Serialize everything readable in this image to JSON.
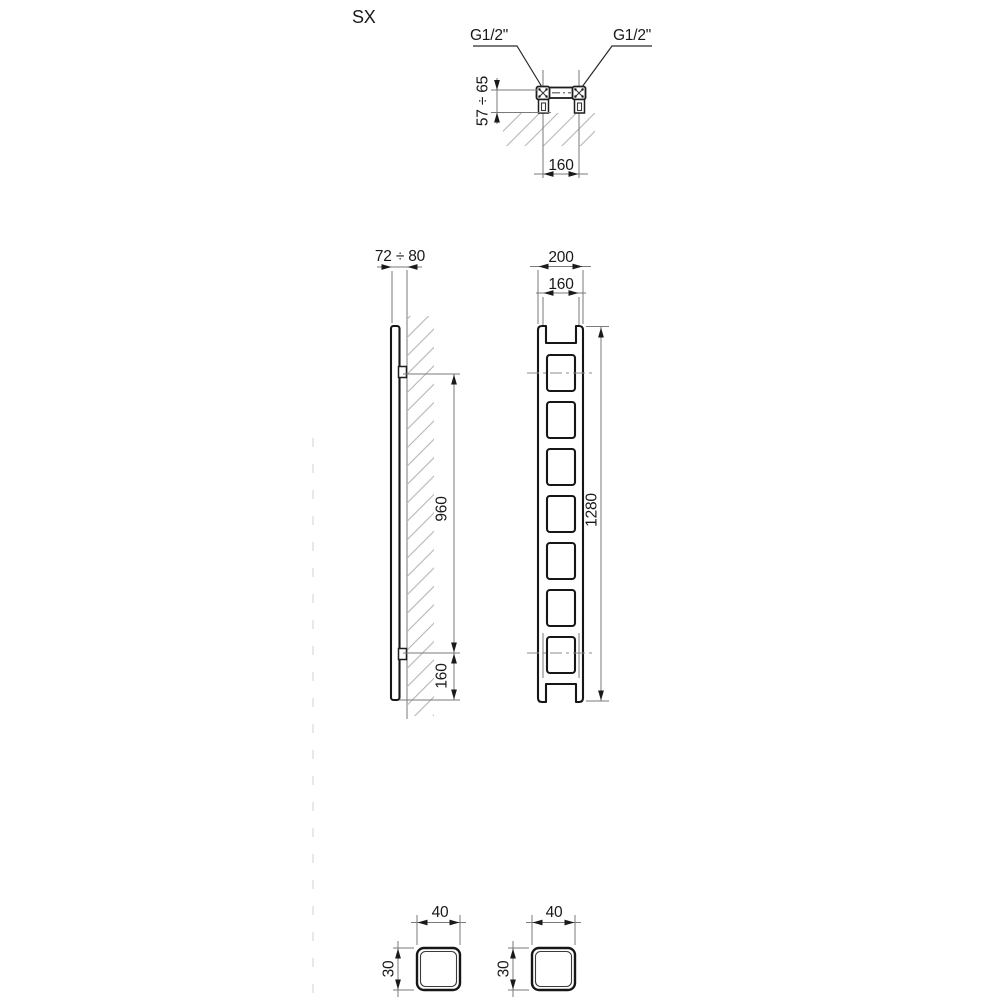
{
  "colors": {
    "background": "#ffffff",
    "outline": "#161616",
    "dimension_lines": "#7a7a7a",
    "hatch": "#b6b6b6",
    "fold_line": "#dcdcdc"
  },
  "drawing": {
    "model_label": "SX",
    "top_view": {
      "connection_left_label": "G1/2\"",
      "connection_right_label": "G1/2\"",
      "wall_clearance": "57 ÷ 65",
      "connection_spacing": "160"
    },
    "side_view": {
      "depth_from_wall": "72 ÷ 80",
      "bracket_spacing": "960",
      "bracket_bottom_offset": "160"
    },
    "front_view": {
      "overall_width": "200",
      "connection_spacing": "160",
      "overall_height": "1280"
    },
    "tube_sections": {
      "left": {
        "width": "40",
        "height": "30"
      },
      "right": {
        "width": "40",
        "height": "30"
      }
    }
  }
}
